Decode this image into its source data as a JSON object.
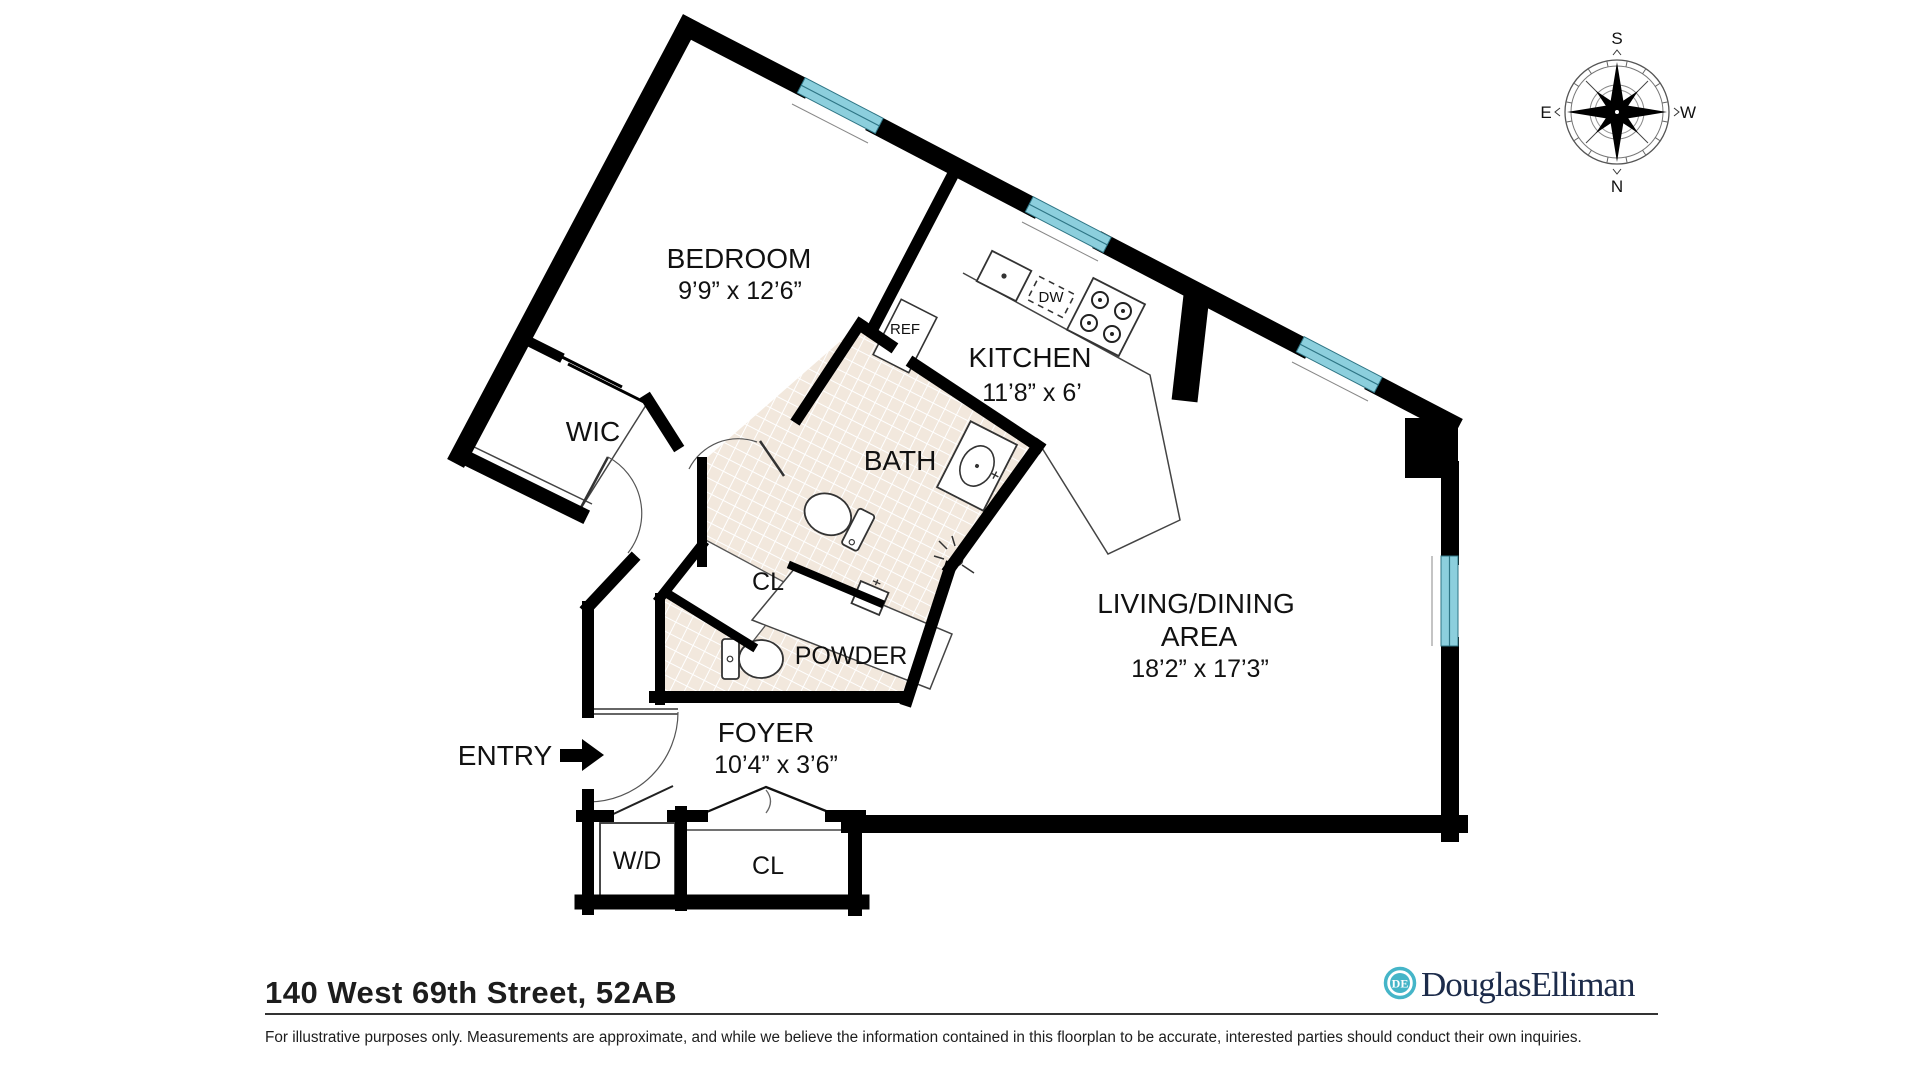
{
  "compass": {
    "top": "S",
    "bottom": "N",
    "left": "E",
    "right": "W"
  },
  "rooms": [
    {
      "id": "bedroom",
      "name": "BEDROOM",
      "dims": "9’9” x 12’6”"
    },
    {
      "id": "wic",
      "name": "WIC"
    },
    {
      "id": "kitchen",
      "name": "KITCHEN",
      "dims": "11’8” x 6’"
    },
    {
      "id": "bath",
      "name": "BATH"
    },
    {
      "id": "hall-closet",
      "name": "CL"
    },
    {
      "id": "powder",
      "name": "POWDER"
    },
    {
      "id": "living-dining",
      "name": "LIVING/DINING",
      "name2": "AREA",
      "dims": "18’2” x 17’3”"
    },
    {
      "id": "foyer",
      "name": "FOYER",
      "dims": "10’4” x 3’6”"
    },
    {
      "id": "washer-dryer",
      "name": "W/D"
    },
    {
      "id": "foyer-closet",
      "name": "CL"
    }
  ],
  "labels": {
    "entry": "ENTRY",
    "ref": "REF",
    "dw": "DW"
  },
  "footer": {
    "address": "140 West 69th Street, 52AB",
    "disclaimer": "For illustrative purposes only.  Measurements are approximate, and while we believe the information contained in this floorplan to be accurate, interested parties should conduct their own inquiries.",
    "brand": "DouglasElliman",
    "brand_monogram": "DE"
  },
  "colors": {
    "wall": "#000000",
    "window": "#8ccfdd",
    "tile": "#f2e8dd",
    "brand_teal": "#45b5c8",
    "brand_navy": "#1c2b4a"
  }
}
